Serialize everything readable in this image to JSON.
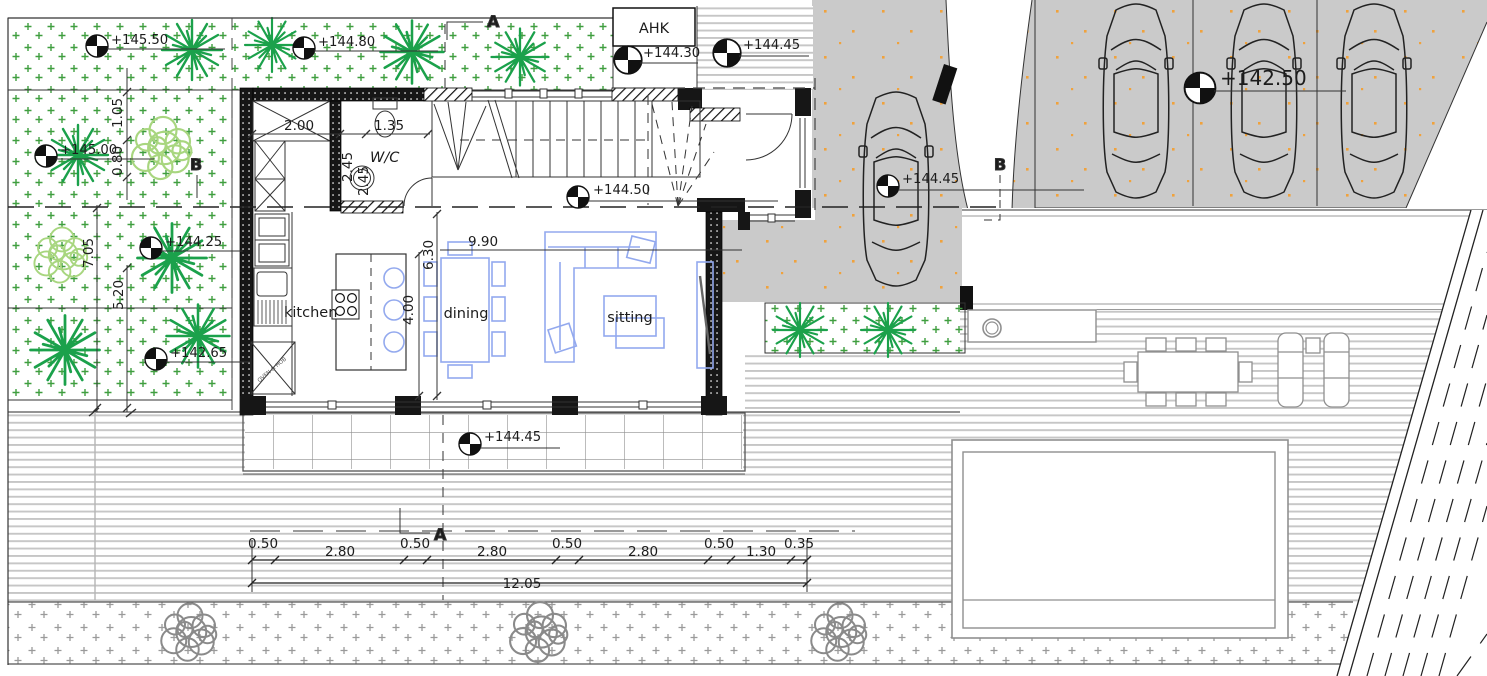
{
  "drawing": {
    "type": "ground-floor-architectural-plan",
    "labels": {
      "ahk": "AHK",
      "wc": "W/C",
      "kitchen": "kitchen",
      "dining": "dining",
      "sitting": "sitting",
      "oven_hob": "OVEN & HOB"
    },
    "sections": {
      "a": "A",
      "b": "B"
    },
    "levels": [
      {
        "name": "garden-nw",
        "label": "+145.50"
      },
      {
        "name": "garden-n",
        "label": "+144.80"
      },
      {
        "name": "entry-path",
        "label": "+144.30"
      },
      {
        "name": "entry-steps",
        "label": "+144.45"
      },
      {
        "name": "garden-w",
        "label": "+145.00"
      },
      {
        "name": "garden-mid",
        "label": "+144.25"
      },
      {
        "name": "garden-sw",
        "label": "+142.65"
      },
      {
        "name": "hall",
        "label": "+144.50"
      },
      {
        "name": "driveway",
        "label": "+144.45"
      },
      {
        "name": "street",
        "label": "+142.50"
      },
      {
        "name": "terrace",
        "label": "+144.45"
      }
    ],
    "dims": {
      "storage_width": "2.00",
      "wc_width": "1.35",
      "storage_depth": "2.45",
      "wc_depth": "2.45",
      "offset_a": "1.05",
      "offset_b": "0.80",
      "garden_length": "7.05",
      "garden_width": "5.20",
      "living_depth": "6.30",
      "living_half": "4.00",
      "living_width": "9.90",
      "chain": [
        "0.50",
        "2.80",
        "0.50",
        "2.80",
        "0.50",
        "2.80",
        "0.50",
        "1.30",
        "0.35"
      ],
      "chain_total": "12.05"
    },
    "colors": {
      "garden_symbol": "#3f9e3f",
      "tree_dark": "#1ba14b",
      "tree_light": "#a8d67f",
      "road_gray": "#cacaca",
      "speckle_orange": "#f0a23c",
      "furniture_blue": "#93a9ee",
      "wall_black": "#161616"
    }
  }
}
